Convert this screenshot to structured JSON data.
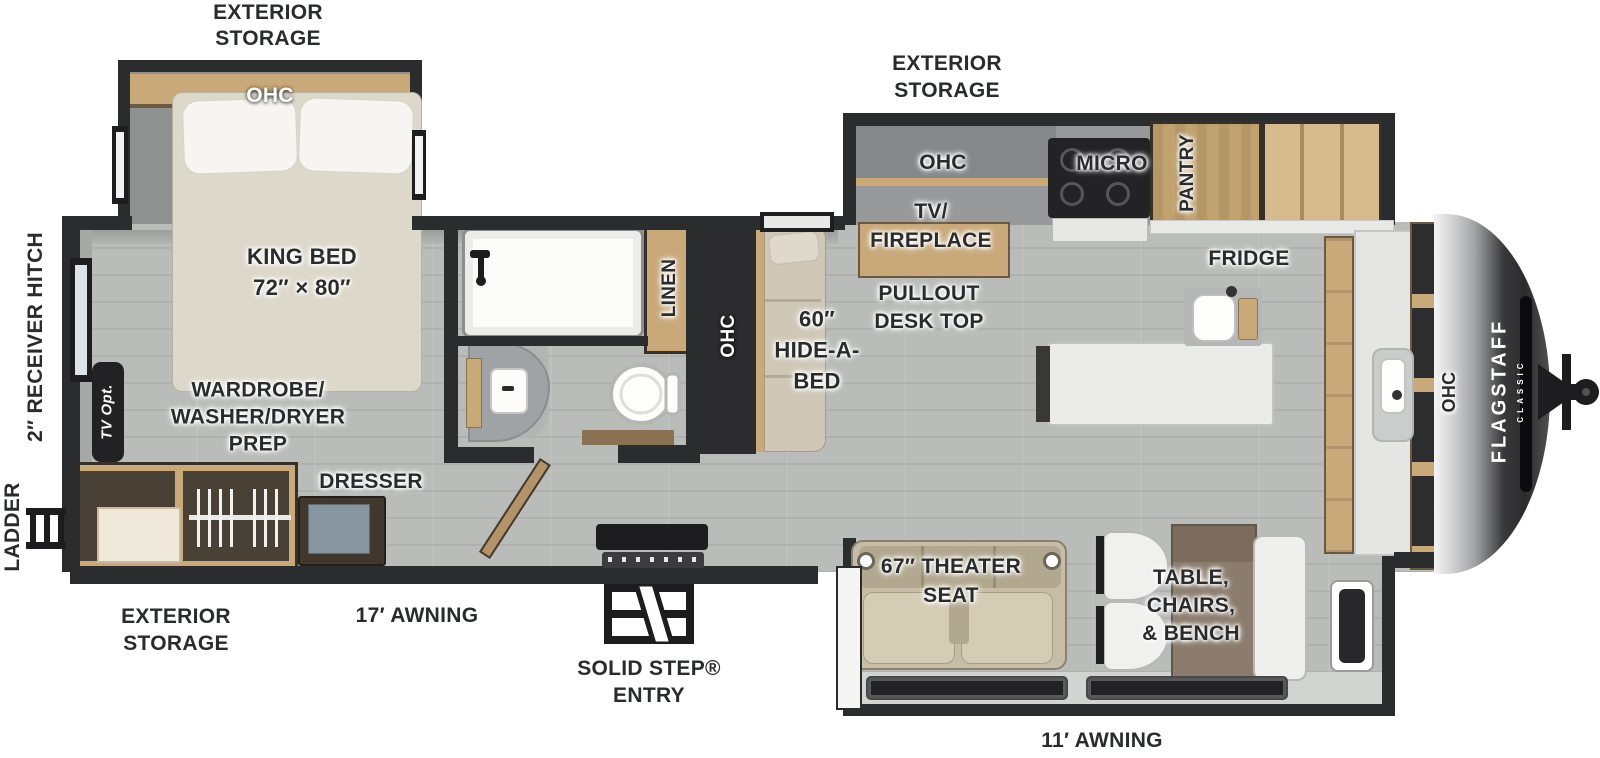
{
  "colors": {
    "wall": "#2b2c2e",
    "wood_cabinet": "#c9a97a",
    "wood_pantry": "#c1a26f",
    "floor": "#b5b9b6",
    "slide_floor": "#8e918f",
    "label_text": "#2a2b2d",
    "front_cap": "#2b2b2d",
    "sofa_beige": "#cfc8b7",
    "theater_beige": "#c7bda6"
  },
  "exterior": {
    "storage_bedroom": {
      "l1": "EXTERIOR",
      "l2": "STORAGE"
    },
    "storage_kitchen": {
      "l1": "EXTERIOR",
      "l2": "STORAGE"
    },
    "storage_rear": {
      "l1": "EXTERIOR",
      "l2": "STORAGE"
    },
    "receiver_hitch": "2″ RECEIVER HITCH",
    "ladder": "LADDER",
    "awning_rear": "17′ AWNING",
    "solid_step": {
      "l1": "SOLID STEP®",
      "l2": "ENTRY"
    },
    "awning_front": "11′ AWNING"
  },
  "bedroom": {
    "ohc": "OHC",
    "king_bed_l1": "KING BED",
    "king_bed_l2": "72″ × 80″",
    "tv_opt": "TV Opt.",
    "wardrobe_l1": "WARDROBE/",
    "wardrobe_l2": "WASHER/DRYER",
    "wardrobe_l3": "PREP",
    "dresser": "DRESSER"
  },
  "bath": {
    "linen": "LINEN"
  },
  "living": {
    "ohc": "OHC",
    "hide_a_bed_l1": "60″",
    "hide_a_bed_l2": "HIDE-A-",
    "hide_a_bed_l3": "BED",
    "theater_l1": "67″ THEATER",
    "theater_l2": "SEAT",
    "dinette_l1": "TABLE,",
    "dinette_l2": "CHAIRS,",
    "dinette_l3": "& BENCH"
  },
  "kitchen": {
    "ohc": "OHC",
    "tv_fireplace_l1": "TV/",
    "tv_fireplace_l2": "FIREPLACE",
    "pullout_l1": "PULLOUT",
    "pullout_l2": "DESK TOP",
    "micro": "MICRO",
    "pantry": "PANTRY",
    "fridge": "FRIDGE",
    "front_ohc": "OHC"
  },
  "brand": {
    "name": "FLAGSTAFF",
    "series": "CLASSIC"
  }
}
